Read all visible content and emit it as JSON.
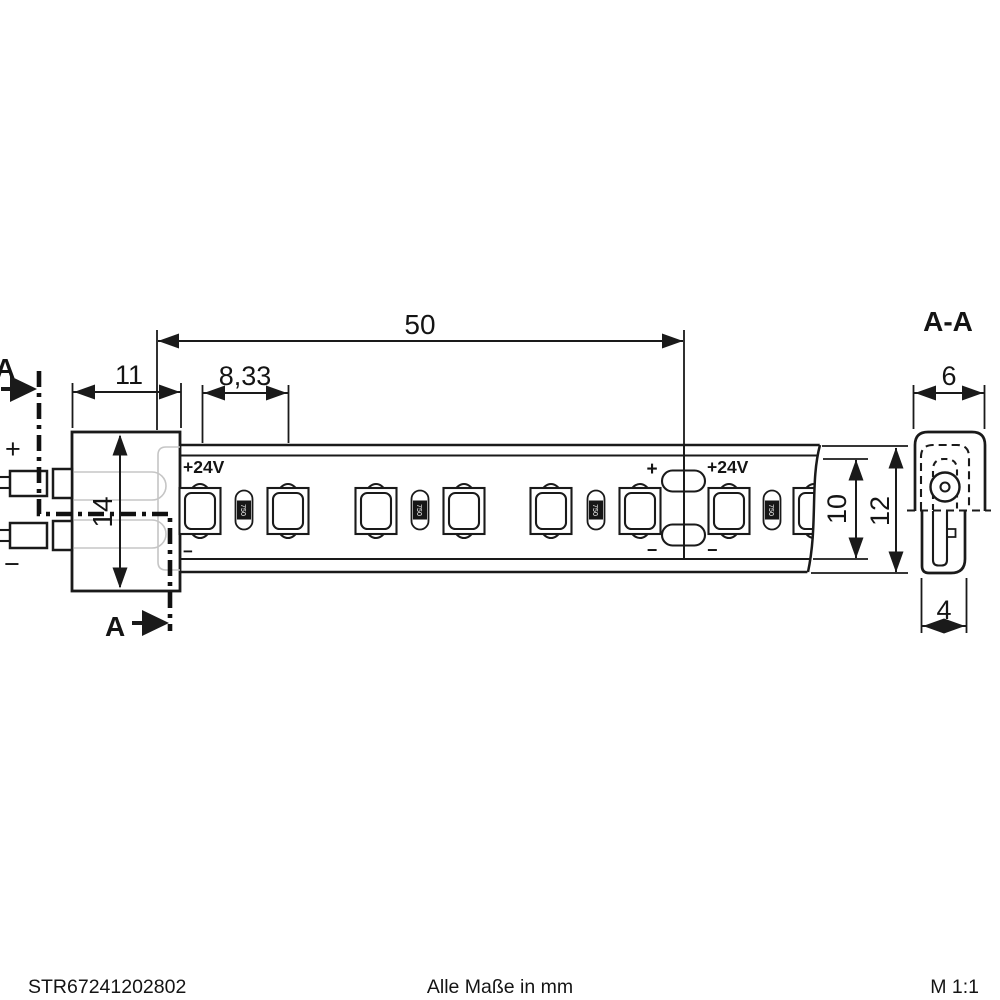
{
  "dimensions": {
    "strip_segment_length": "50",
    "connector_width": "11",
    "led_pitch": "8,33",
    "connector_height": "14",
    "strip_inner_height": "10",
    "strip_outer_height": "12",
    "profile_width": "6",
    "profile_bottom_width": "4"
  },
  "section": {
    "cut_label_top": "A",
    "cut_label_bottom": "A",
    "view_title": "A-A"
  },
  "labels": {
    "wire_positive": "+",
    "wire_negative": "−",
    "voltage_left": "+24V",
    "minus_left": "−",
    "joint_plus": "+",
    "joint_minus_left": "−",
    "voltage_right": "+24V",
    "joint_minus_right": "−",
    "resistor_marking": "750"
  },
  "footer": {
    "article_number": "STR67241202802",
    "units_note": "Alle Maße in mm",
    "scale": "M 1:1"
  },
  "colors": {
    "line": "#1a1a1a",
    "led_lens_fill": "#d9d9d9",
    "resistor_body_fill": "#e3e3e3",
    "resistor_band_fill": "#161616",
    "ghost_line": "#c5c5c5",
    "background": "#ffffff"
  }
}
